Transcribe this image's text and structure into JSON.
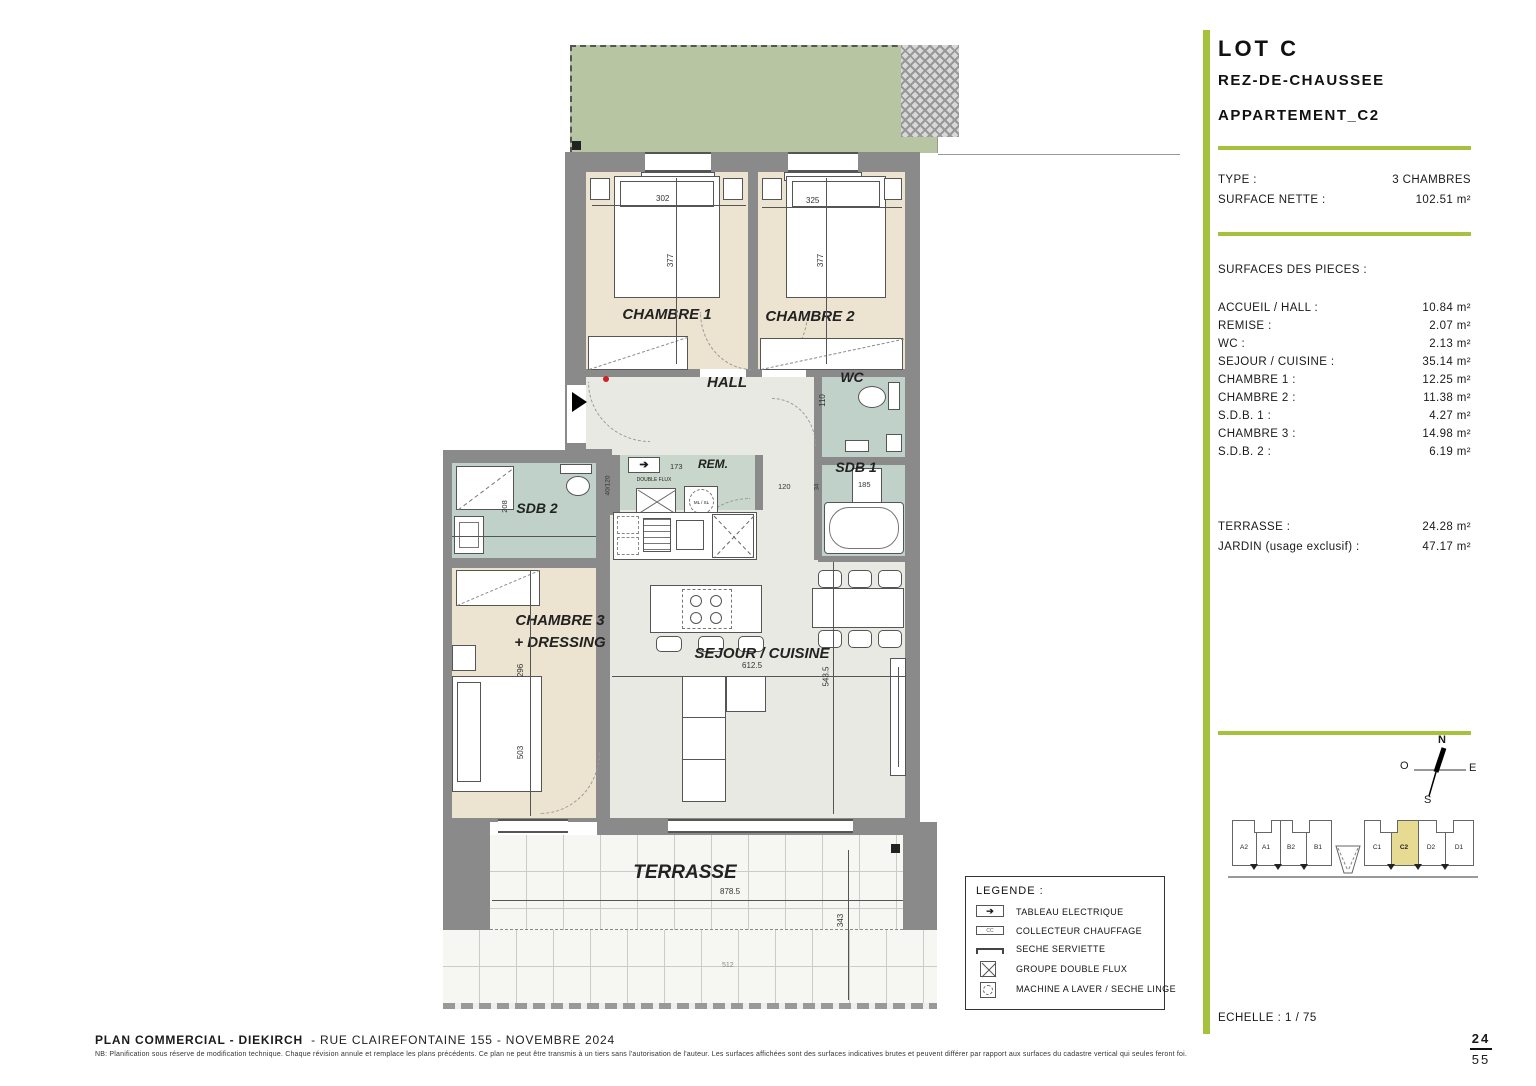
{
  "panel": {
    "lot": "LOT C",
    "level": "REZ-DE-CHAUSSEE",
    "apartment": "APPARTEMENT_C2",
    "type_label": "TYPE :",
    "type_value": "3 CHAMBRES",
    "net_label": "SURFACE NETTE :",
    "net_value": "102.51 m²",
    "surfaces_title": "SURFACES DES PIECES :",
    "surfaces": [
      {
        "label": "ACCUEIL / HALL :",
        "value": "10.84 m²"
      },
      {
        "label": "REMISE :",
        "value": "2.07 m²"
      },
      {
        "label": "WC :",
        "value": "2.13 m²"
      },
      {
        "label": "SEJOUR / CUISINE :",
        "value": "35.14 m²"
      },
      {
        "label": "CHAMBRE 1 :",
        "value": "12.25 m²"
      },
      {
        "label": "CHAMBRE 2 :",
        "value": "11.38 m²"
      },
      {
        "label": "S.D.B. 1 :",
        "value": "4.27 m²"
      },
      {
        "label": "CHAMBRE 3 :",
        "value": "14.98 m²"
      },
      {
        "label": "S.D.B. 2 :",
        "value": "6.19 m²"
      }
    ],
    "outdoor": [
      {
        "label": "TERRASSE :",
        "value": "24.28 m²"
      },
      {
        "label": "JARDIN (usage exclusif) :",
        "value": "47.17 m²"
      }
    ],
    "scale": "ECHELLE : 1 / 75",
    "compass": {
      "n": "N",
      "e": "E",
      "s": "S",
      "w": "O"
    },
    "units": [
      "A2",
      "A1",
      "B2",
      "B1",
      "C1",
      "C2",
      "D2",
      "D1"
    ],
    "highlighted_unit": "C2"
  },
  "legend": {
    "title": "LEGENDE :",
    "items": [
      "TABLEAU ELECTRIQUE",
      "COLLECTEUR CHAUFFAGE",
      "SECHE SERVIETTE",
      "GROUPE DOUBLE FLUX",
      "MACHINE A LAVER / SECHE LINGE"
    ],
    "cc": "CC"
  },
  "plan": {
    "rooms": {
      "chambre1": "CHAMBRE 1",
      "chambre2": "CHAMBRE 2",
      "hall": "HALL",
      "wc": "WC",
      "sdb1": "SDB 1",
      "rem": "REM.",
      "sdb2": "SDB 2",
      "chambre3_l1": "CHAMBRE 3",
      "chambre3_l2": "+ DRESSING",
      "sejour": "SEJOUR / CUISINE",
      "terrasse": "TERRASSE"
    },
    "dims": {
      "c1_w": "302",
      "c2_w": "325",
      "c1_h": "377",
      "c2_h": "377",
      "wc_h": "110",
      "rem_w": "173",
      "rem_d": "40/120",
      "corr": "120",
      "sdb1_w": "185",
      "sdb1_s": "34",
      "sdb2_h": "208",
      "c3_w": "296",
      "c3_h": "503",
      "sej_w": "612.5",
      "sej_h": "543.5",
      "ter_w": "878.5",
      "ter_h": "343",
      "site": "512"
    },
    "equip": {
      "double_flux": "DOUBLE FLUX",
      "ml": "ML / SL"
    }
  },
  "footer": {
    "title_bold": "PLAN COMMERCIAL - DIEKIRCH",
    "title_rest": "- RUE CLAIREFONTAINE 155 - NOVEMBRE 2024",
    "note": "NB: Planification sous réserve de modification technique. Chaque révision annule et remplace les plans précédents. Ce plan ne peut être transmis à un tiers sans l'autorisation de l'auteur. Les surfaces affichées sont des surfaces indicatives brutes et peuvent différer par rapport aux surfaces du cadastre vertical qui seules feront foi.",
    "page_num": "24",
    "page_total": "55"
  },
  "colors": {
    "accent": "#a6c13c",
    "garden": "#b7c5a2",
    "bedroom": "#ece3d0",
    "bath": "#c0d1c9",
    "floor": "#e9e9e4",
    "wall": "#8a8a8a",
    "highlight": "#e7da92"
  }
}
